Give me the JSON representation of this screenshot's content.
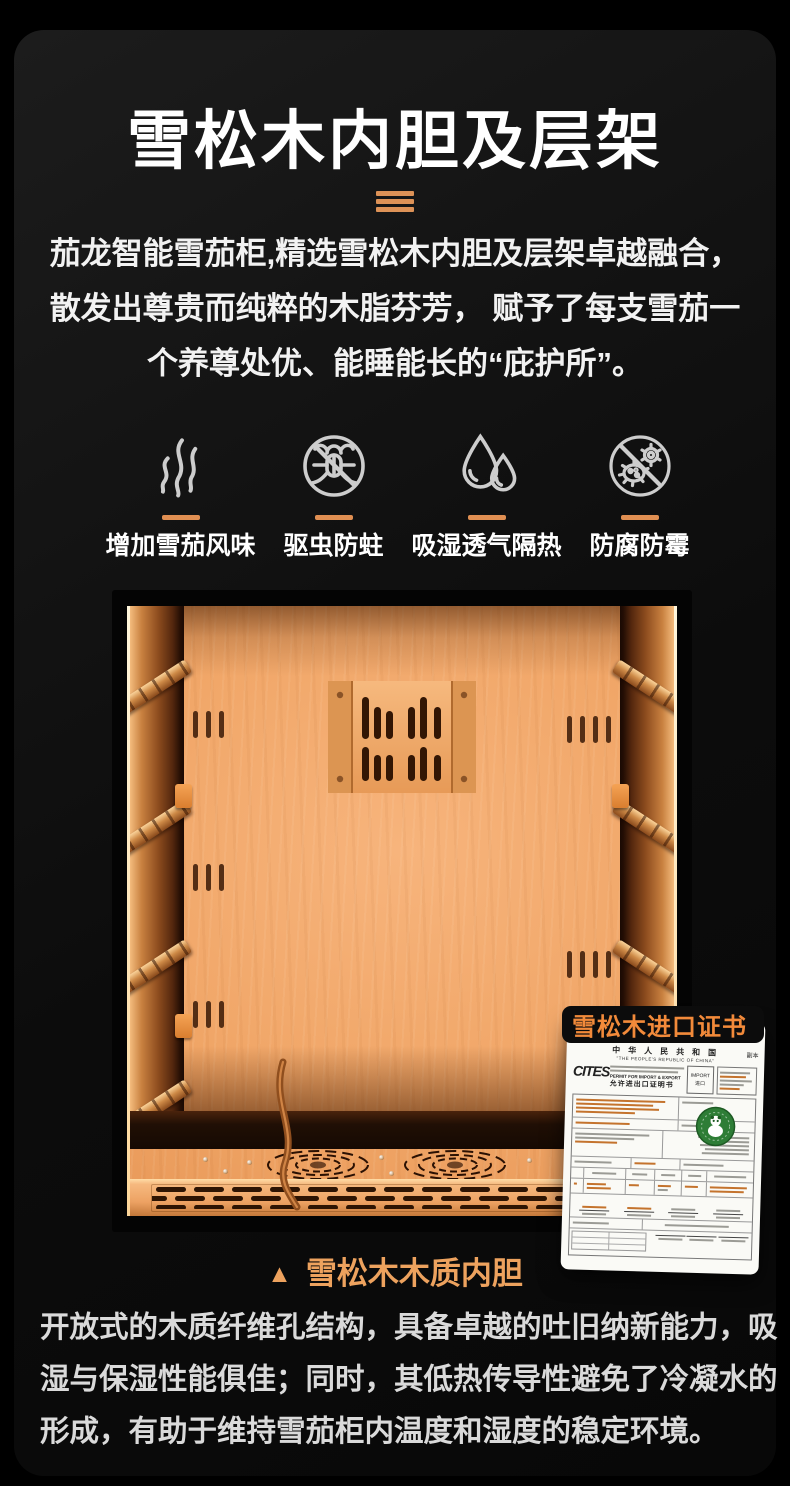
{
  "accent": {
    "orange_divider": "#DD9257",
    "orange_caption": "#EDA25E",
    "orange_cert_tag": "#F28A3A",
    "wood_main": "#F0A566"
  },
  "header": {
    "title": "雪松木内胆及层架"
  },
  "intro": {
    "lines": [
      "茄龙智能雪茄柜,精选雪松木内胆及层架卓越融合，",
      "散发出尊贵而纯粹的木脂芬芳， 赋予了每支雪茄一",
      "个养尊处优、能睡能长的“庇护所”。"
    ]
  },
  "features": [
    {
      "icon": "aroma-smoke-icon",
      "label": "增加雪茄风味"
    },
    {
      "icon": "no-insect-icon",
      "label": "驱虫防蛀"
    },
    {
      "icon": "water-drops-icon",
      "label": "吸湿透气隔热"
    },
    {
      "icon": "no-mold-icon",
      "label": "防腐防霉"
    }
  ],
  "photo": {
    "caption_marker": "▲",
    "caption": "雪松木木质内胆"
  },
  "certificate": {
    "tag": "雪松木进口证书",
    "country_cn": "中 华 人 民 共 和 国",
    "country_en": "\"THE PEOPLE'S REPUBLIC OF CHINA\"",
    "copy_mark": "副本",
    "logo": "CITES",
    "permit_line1": "PERMIT FOR IMPORT & EXPORT",
    "permit_line2": "允许进出口证明书",
    "import_en": "IMPORT",
    "import_cn": "进口"
  },
  "footer": {
    "lines": [
      "开放式的木质纤维孔结构，具备卓越的吐旧纳新能力，吸",
      "湿与保湿性能俱佳；同时，其低热传导性避免了冷凝水的",
      "形成，有助于维持雪茄柜内温度和湿度的稳定环境。"
    ]
  }
}
